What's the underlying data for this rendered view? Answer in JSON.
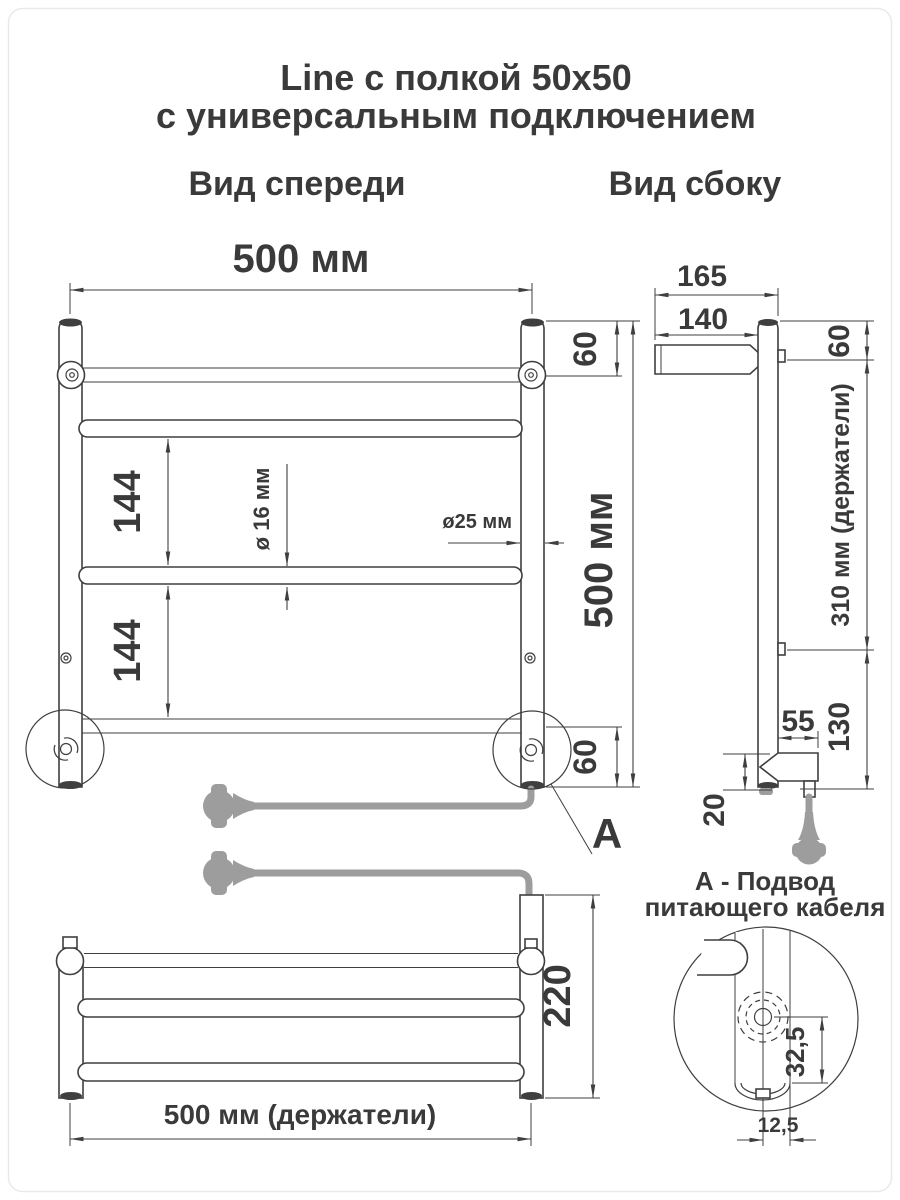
{
  "title": {
    "line1": "Line с полкой 50x50",
    "line2": "с универсальным подключением"
  },
  "views": {
    "front": "Вид спереди",
    "side": "Вид сбоку"
  },
  "front": {
    "width": "500 мм",
    "offset_top": "60",
    "gap1": "144",
    "gap2": "144",
    "tube_dia": "ø 16 мм",
    "post_dia": "ø25 мм",
    "height": "500 мм",
    "offset_bottom": "60",
    "detail_label": "А"
  },
  "side": {
    "total_depth": "165",
    "shelf_depth": "140",
    "offset_top": "60",
    "holders_span": "310 мм (держатели)",
    "bottom_span": "130",
    "holder_depth": "55",
    "clearance": "20"
  },
  "top_view": {
    "depth": "220",
    "holders_width": "500 мм (держатели)"
  },
  "detail": {
    "title1": "А - Подвод",
    "title2": "питающего кабеля",
    "gland_offset": "32,5",
    "radius_offset": "12,5"
  },
  "colors": {
    "line": "#3f3f3f",
    "cable": "#9d9d9d",
    "background": "#ffffff"
  }
}
